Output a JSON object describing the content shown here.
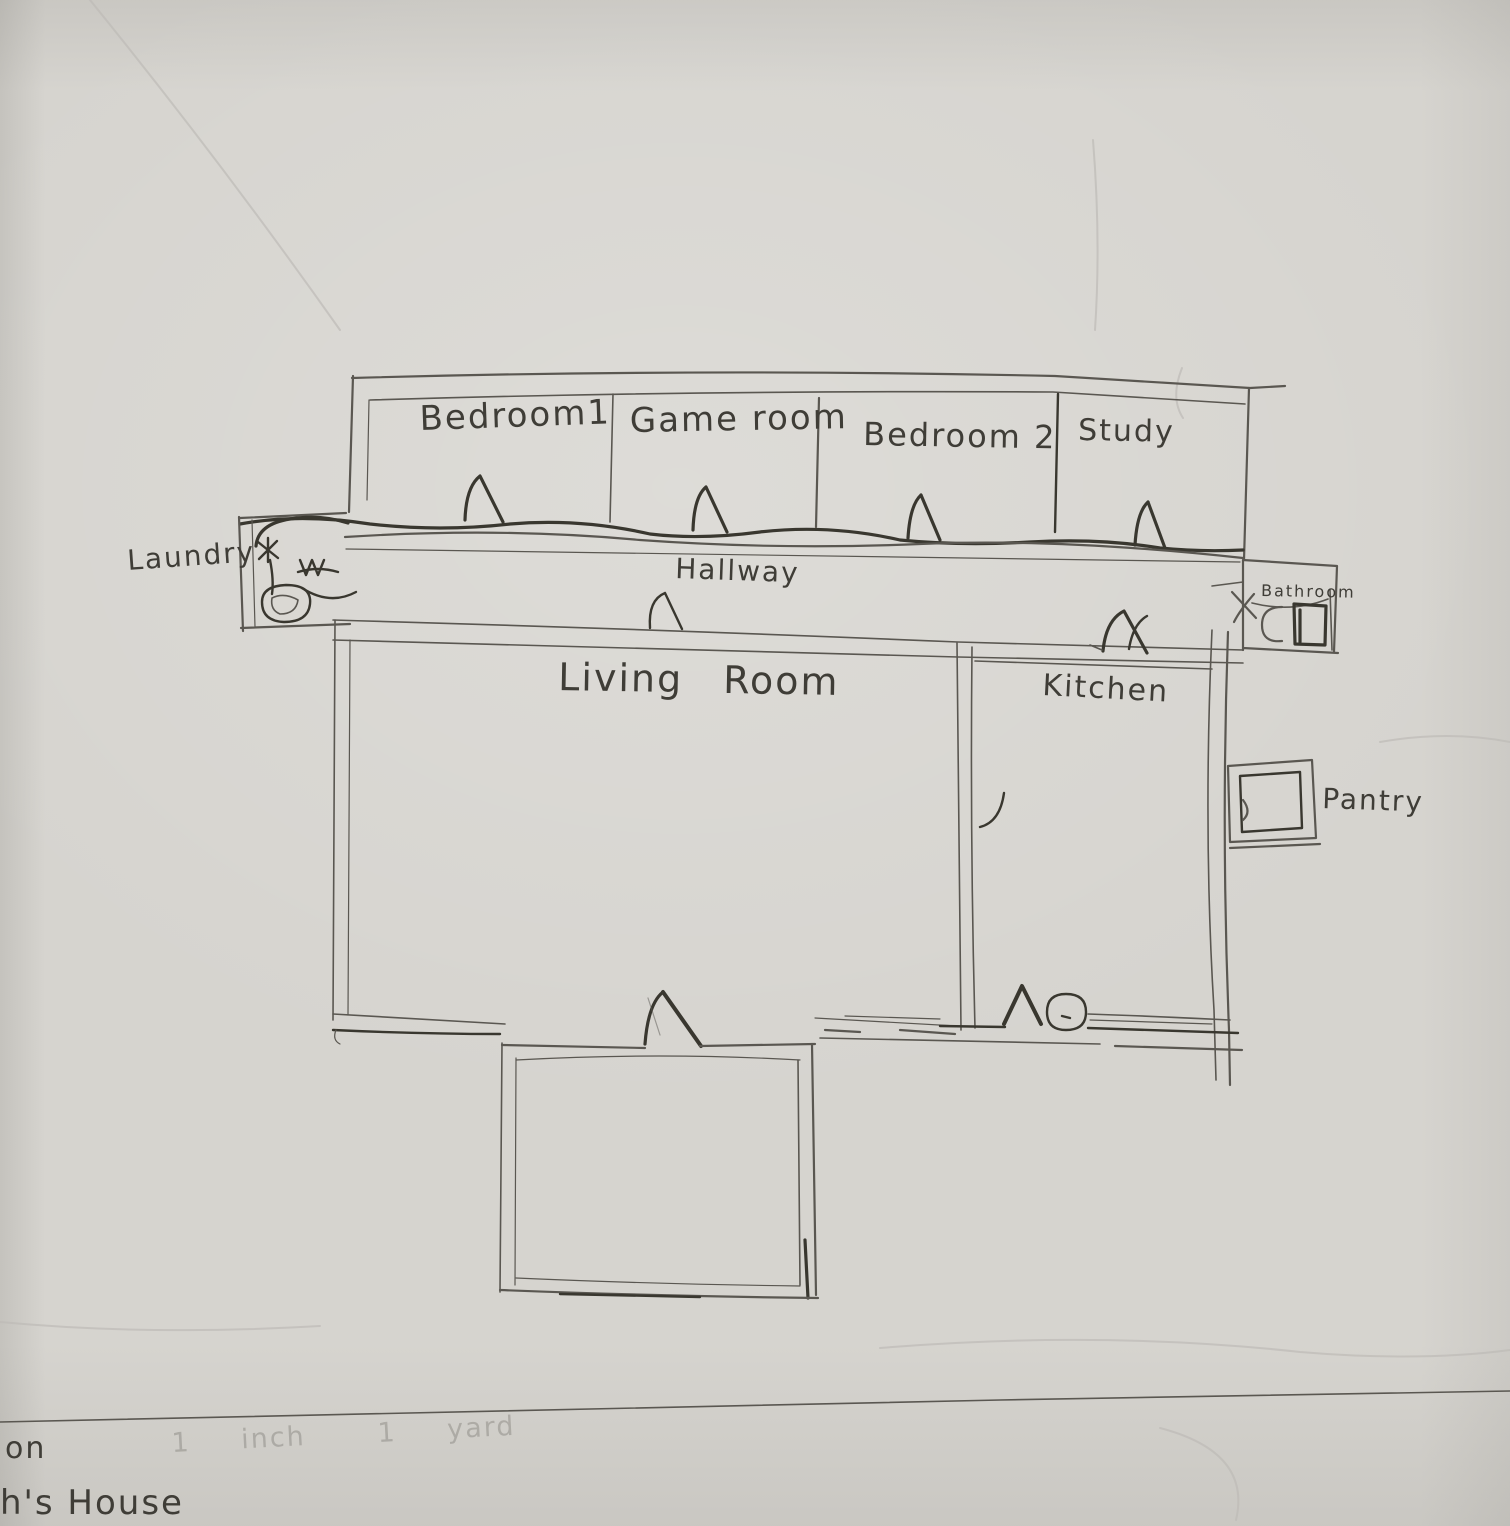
{
  "palette": {
    "paper": "#d6d4cf",
    "paper_light": "#dedcd7",
    "paper_dark": "#c7c5c1",
    "pencil": "#5a5751",
    "pencil_dark": "#39372f",
    "crease": "#bdbbb6"
  },
  "rooms": {
    "bedroom1": {
      "label": "Bedroom1"
    },
    "game_room": {
      "label": "Game room"
    },
    "bedroom2": {
      "label": "Bedroom 2"
    },
    "study": {
      "label": "Study"
    },
    "laundry": {
      "label": "Laundry"
    },
    "hallway": {
      "label": "Hallway"
    },
    "bathroom": {
      "label": "Bathroom"
    },
    "living_room": {
      "label": "Living Room"
    },
    "kitchen": {
      "label": "Kitchen"
    },
    "pantry": {
      "label": "Pantry"
    }
  },
  "footer": {
    "fragment_line1": "on",
    "fragment_line2": "h's House",
    "scale_fragment_1": "1 inch",
    "scale_fragment_2": "1 yard"
  }
}
